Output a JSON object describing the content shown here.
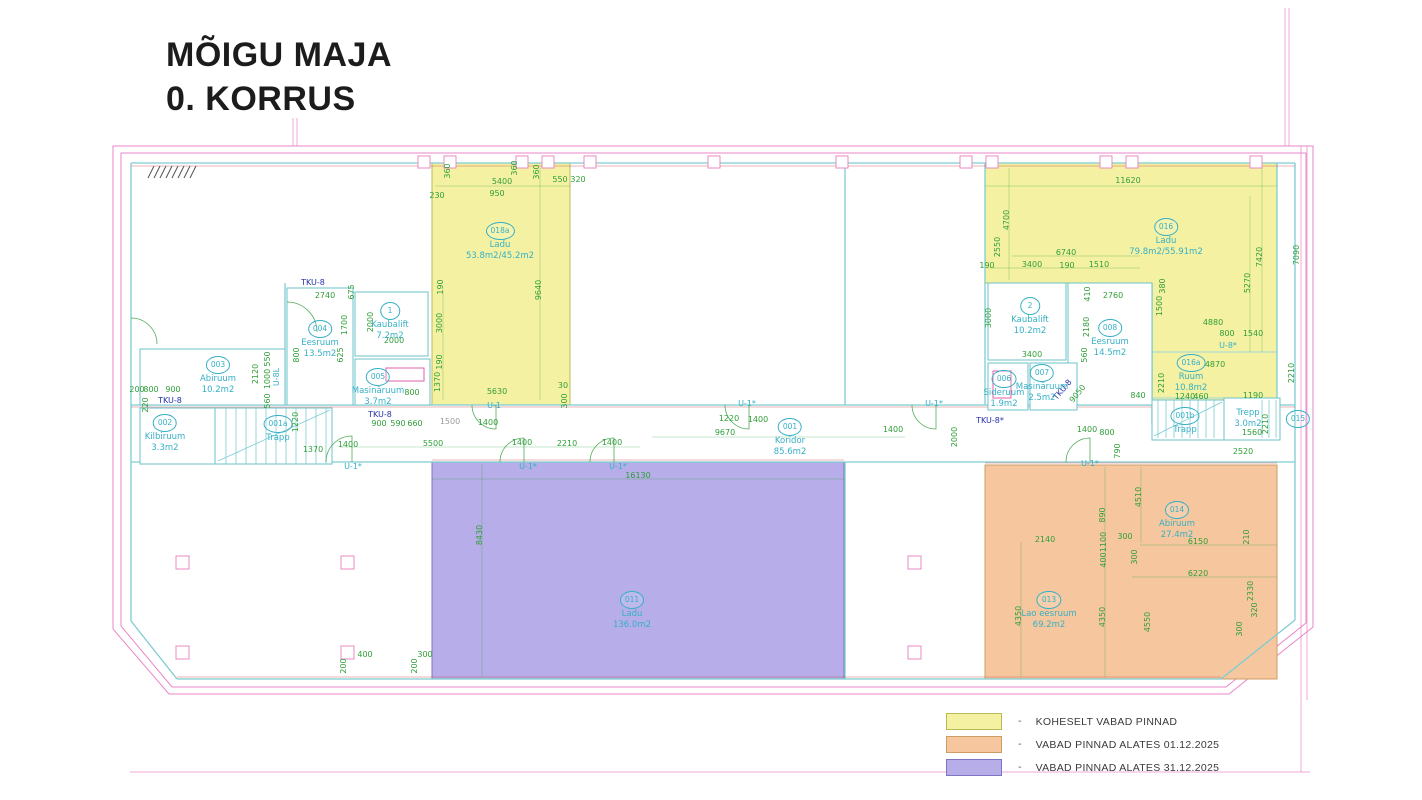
{
  "title": {
    "line1": "MÕIGU MAJA",
    "line2": "0. KORRUS"
  },
  "legend": {
    "separator": "-",
    "items": [
      {
        "key": "available_now",
        "label": "KOHESELT VABAD PINNAD"
      },
      {
        "key": "available_2025_12_01",
        "label": "VABAD PINNAD ALATES 01.12.2025"
      },
      {
        "key": "available_2025_12_31",
        "label": "VABAD PINNAD ALATES 31.12.2025"
      }
    ]
  },
  "colors": {
    "available_now": "#f5f1a2",
    "available_2025_12_01": "#f6c79e",
    "available_2025_12_31": "#b6ade9",
    "dimension_green": "#2f9e38",
    "room_label_cyan": "#35b0c6",
    "reference_navy": "#2430a8",
    "wall_teal": "#7ecdd2",
    "outline_pink": "#ea86c8"
  },
  "plan": {
    "rooms": [
      {
        "x": 500,
        "y": 222,
        "number": "018a",
        "name": "Ladu",
        "area": "53.8m2/45.2m2"
      },
      {
        "x": 1166,
        "y": 218,
        "number": "016",
        "name": "Ladu",
        "area": "79.8m2/55.91m2"
      },
      {
        "x": 1191,
        "y": 354,
        "number": "016a",
        "name": "Ruum",
        "area": "10.8m2"
      },
      {
        "x": 390,
        "y": 302,
        "number": "1",
        "name": "Kaubalift",
        "area": "7.2m2"
      },
      {
        "x": 1030,
        "y": 297,
        "number": "2",
        "name": "Kaubalift",
        "area": "10.2m2"
      },
      {
        "x": 320,
        "y": 320,
        "number": "004",
        "name": "Eesruum",
        "area": "13.5m2"
      },
      {
        "x": 378,
        "y": 368,
        "number": "005",
        "name": "Masinäruum",
        "area": "3.7m2"
      },
      {
        "x": 218,
        "y": 356,
        "number": "003",
        "name": "Abiruum",
        "area": "10.2m2"
      },
      {
        "x": 165,
        "y": 414,
        "number": "002",
        "name": "Kilbiruum",
        "area": "3.3m2"
      },
      {
        "x": 278,
        "y": 415,
        "number": "001a",
        "name": "Trapp",
        "area": ""
      },
      {
        "x": 790,
        "y": 418,
        "number": "001",
        "name": "Koridor",
        "area": "85.6m2"
      },
      {
        "x": 1185,
        "y": 407,
        "number": "001b",
        "name": "Trapp",
        "area": ""
      },
      {
        "x": 1004,
        "y": 370,
        "number": "006",
        "name": "Sideruum",
        "area": "1.9m2"
      },
      {
        "x": 1042,
        "y": 364,
        "number": "007",
        "name": "Masinäruum",
        "area": "2.5m2"
      },
      {
        "x": 1110,
        "y": 319,
        "number": "008",
        "name": "Eesruum",
        "area": "14.5m2"
      },
      {
        "x": 632,
        "y": 591,
        "number": "011",
        "name": "Ladu",
        "area": "136.0m2"
      },
      {
        "x": 1049,
        "y": 591,
        "number": "013",
        "name": "Lao eesruum",
        "area": "69.2m2"
      },
      {
        "x": 1177,
        "y": 501,
        "number": "014",
        "name": "Abiruum",
        "area": "27.4m2"
      },
      {
        "x": 1298,
        "y": 410,
        "number": "015",
        "name": "",
        "area": ""
      },
      {
        "x": 1248,
        "y": 408,
        "number": "",
        "name": "Trepp",
        "area": "3.0m2"
      }
    ],
    "annotations": [
      {
        "x": 502,
        "y": 182,
        "t": "5400"
      },
      {
        "x": 497,
        "y": 194,
        "t": "950"
      },
      {
        "x": 560,
        "y": 180,
        "t": "550"
      },
      {
        "x": 578,
        "y": 180,
        "t": "320"
      },
      {
        "x": 437,
        "y": 196,
        "t": "230"
      },
      {
        "x": 448,
        "y": 171,
        "t": "360",
        "r": -90
      },
      {
        "x": 515,
        "y": 168,
        "t": "360",
        "r": -90
      },
      {
        "x": 537,
        "y": 172,
        "t": "360",
        "r": -90
      },
      {
        "x": 441,
        "y": 287,
        "t": "190",
        "r": -90
      },
      {
        "x": 440,
        "y": 323,
        "t": "3000",
        "r": -90
      },
      {
        "x": 440,
        "y": 362,
        "t": "190",
        "r": -90
      },
      {
        "x": 438,
        "y": 382,
        "t": "1370",
        "r": -90
      },
      {
        "x": 497,
        "y": 392,
        "t": "5630"
      },
      {
        "x": 563,
        "y": 386,
        "t": "30"
      },
      {
        "x": 565,
        "y": 401,
        "t": "300",
        "r": -90
      },
      {
        "x": 539,
        "y": 290,
        "t": "9640",
        "r": -90
      },
      {
        "x": 325,
        "y": 296,
        "t": "2740"
      },
      {
        "x": 352,
        "y": 292,
        "t": "675",
        "r": -90
      },
      {
        "x": 345,
        "y": 325,
        "t": "1700",
        "r": -90
      },
      {
        "x": 371,
        "y": 322,
        "t": "2000",
        "r": -90
      },
      {
        "x": 394,
        "y": 341,
        "t": "2000"
      },
      {
        "x": 341,
        "y": 355,
        "t": "625",
        "r": -90
      },
      {
        "x": 297,
        "y": 355,
        "t": "800",
        "r": -90
      },
      {
        "x": 137,
        "y": 390,
        "t": "200"
      },
      {
        "x": 151,
        "y": 390,
        "t": "800"
      },
      {
        "x": 173,
        "y": 390,
        "t": "900"
      },
      {
        "x": 146,
        "y": 405,
        "t": "220",
        "r": -90
      },
      {
        "x": 256,
        "y": 374,
        "t": "2120",
        "r": -90
      },
      {
        "x": 268,
        "y": 379,
        "t": "1000",
        "r": -90
      },
      {
        "x": 268,
        "y": 359,
        "t": "550",
        "r": -90
      },
      {
        "x": 268,
        "y": 401,
        "t": "560",
        "r": -90
      },
      {
        "x": 296,
        "y": 422,
        "t": "1220",
        "r": -90
      },
      {
        "x": 313,
        "y": 450,
        "t": "1370"
      },
      {
        "x": 412,
        "y": 393,
        "t": "800"
      },
      {
        "x": 379,
        "y": 424,
        "t": "900"
      },
      {
        "x": 398,
        "y": 424,
        "t": "590"
      },
      {
        "x": 415,
        "y": 424,
        "t": "660"
      },
      {
        "x": 450,
        "y": 422,
        "t": "1500",
        "c": "gy"
      },
      {
        "x": 488,
        "y": 423,
        "t": "1400"
      },
      {
        "x": 348,
        "y": 445,
        "t": "1400"
      },
      {
        "x": 433,
        "y": 444,
        "t": "5500"
      },
      {
        "x": 522,
        "y": 443,
        "t": "1400"
      },
      {
        "x": 567,
        "y": 444,
        "t": "2210"
      },
      {
        "x": 612,
        "y": 443,
        "t": "1400"
      },
      {
        "x": 638,
        "y": 476,
        "t": "16130"
      },
      {
        "x": 725,
        "y": 433,
        "t": "9670"
      },
      {
        "x": 729,
        "y": 419,
        "t": "1220"
      },
      {
        "x": 758,
        "y": 420,
        "t": "1400"
      },
      {
        "x": 893,
        "y": 430,
        "t": "1400"
      },
      {
        "x": 955,
        "y": 437,
        "t": "2000",
        "r": -90
      },
      {
        "x": 1087,
        "y": 430,
        "t": "1400"
      },
      {
        "x": 1107,
        "y": 433,
        "t": "800"
      },
      {
        "x": 1118,
        "y": 451,
        "t": "790",
        "r": -90
      },
      {
        "x": 480,
        "y": 535,
        "t": "8430",
        "r": -90
      },
      {
        "x": 989,
        "y": 318,
        "t": "3000",
        "r": -90
      },
      {
        "x": 1032,
        "y": 355,
        "t": "3400"
      },
      {
        "x": 1087,
        "y": 327,
        "t": "2180",
        "r": -90
      },
      {
        "x": 1113,
        "y": 296,
        "t": "2760"
      },
      {
        "x": 1088,
        "y": 294,
        "t": "410",
        "r": -90
      },
      {
        "x": 1085,
        "y": 355,
        "t": "560",
        "r": -90
      },
      {
        "x": 1138,
        "y": 396,
        "t": "840"
      },
      {
        "x": 1078,
        "y": 394,
        "t": "9050",
        "r": -50
      },
      {
        "x": 1128,
        "y": 181,
        "t": "11620"
      },
      {
        "x": 1007,
        "y": 220,
        "t": "4700",
        "r": -90
      },
      {
        "x": 998,
        "y": 247,
        "t": "2550",
        "r": -90
      },
      {
        "x": 1066,
        "y": 253,
        "t": "6740"
      },
      {
        "x": 1032,
        "y": 265,
        "t": "3400"
      },
      {
        "x": 987,
        "y": 266,
        "t": "190"
      },
      {
        "x": 1067,
        "y": 266,
        "t": "190"
      },
      {
        "x": 1099,
        "y": 265,
        "t": "1510"
      },
      {
        "x": 1260,
        "y": 257,
        "t": "7420",
        "r": -90
      },
      {
        "x": 1248,
        "y": 283,
        "t": "5270",
        "r": -90
      },
      {
        "x": 1163,
        "y": 286,
        "t": "380",
        "r": -90
      },
      {
        "x": 1160,
        "y": 306,
        "t": "1500",
        "r": -90
      },
      {
        "x": 1213,
        "y": 323,
        "t": "4880"
      },
      {
        "x": 1227,
        "y": 334,
        "t": "800"
      },
      {
        "x": 1253,
        "y": 334,
        "t": "1540"
      },
      {
        "x": 1215,
        "y": 365,
        "t": "4870"
      },
      {
        "x": 1162,
        "y": 383,
        "t": "2210",
        "r": -90
      },
      {
        "x": 1185,
        "y": 397,
        "t": "1240"
      },
      {
        "x": 1201,
        "y": 397,
        "t": "460"
      },
      {
        "x": 1253,
        "y": 396,
        "t": "1190"
      },
      {
        "x": 1292,
        "y": 373,
        "t": "2210",
        "r": -90
      },
      {
        "x": 1297,
        "y": 255,
        "t": "7090",
        "r": -90
      },
      {
        "x": 1252,
        "y": 433,
        "t": "1560"
      },
      {
        "x": 1266,
        "y": 424,
        "t": "2210",
        "r": -90
      },
      {
        "x": 1243,
        "y": 452,
        "t": "2520"
      },
      {
        "x": 1045,
        "y": 540,
        "t": "2140"
      },
      {
        "x": 1103,
        "y": 515,
        "t": "890",
        "r": -90
      },
      {
        "x": 1104,
        "y": 542,
        "t": "1100",
        "r": -90
      },
      {
        "x": 1104,
        "y": 560,
        "t": "400",
        "r": -90
      },
      {
        "x": 1139,
        "y": 497,
        "t": "4510",
        "r": -90
      },
      {
        "x": 1125,
        "y": 537,
        "t": "300"
      },
      {
        "x": 1135,
        "y": 557,
        "t": "300",
        "r": -90
      },
      {
        "x": 1198,
        "y": 542,
        "t": "6150"
      },
      {
        "x": 1198,
        "y": 574,
        "t": "6220"
      },
      {
        "x": 1019,
        "y": 616,
        "t": "4350",
        "r": -90
      },
      {
        "x": 1103,
        "y": 617,
        "t": "4350",
        "r": -90
      },
      {
        "x": 1148,
        "y": 622,
        "t": "4550",
        "r": -90
      },
      {
        "x": 1251,
        "y": 591,
        "t": "2330",
        "r": -90
      },
      {
        "x": 1255,
        "y": 610,
        "t": "320",
        "r": -90
      },
      {
        "x": 1240,
        "y": 629,
        "t": "300",
        "r": -90
      },
      {
        "x": 1247,
        "y": 537,
        "t": "210",
        "r": -90
      },
      {
        "x": 365,
        "y": 655,
        "t": "400"
      },
      {
        "x": 425,
        "y": 655,
        "t": "300"
      },
      {
        "x": 344,
        "y": 666,
        "t": "200",
        "r": -90
      },
      {
        "x": 415,
        "y": 666,
        "t": "200",
        "r": -90
      },
      {
        "x": 494,
        "y": 406,
        "t": "U-1",
        "c": "c"
      },
      {
        "x": 353,
        "y": 467,
        "t": "U-1*",
        "c": "c"
      },
      {
        "x": 528,
        "y": 467,
        "t": "U-1*",
        "c": "c"
      },
      {
        "x": 618,
        "y": 467,
        "t": "U-1*",
        "c": "c"
      },
      {
        "x": 747,
        "y": 404,
        "t": "U-1*",
        "c": "c"
      },
      {
        "x": 934,
        "y": 404,
        "t": "U-1*",
        "c": "c"
      },
      {
        "x": 1090,
        "y": 464,
        "t": "U-1*",
        "c": "c"
      },
      {
        "x": 277,
        "y": 377,
        "t": "U-8L",
        "r": -90,
        "c": "c"
      },
      {
        "x": 1228,
        "y": 346,
        "t": "U-8*",
        "c": "c"
      },
      {
        "x": 313,
        "y": 283,
        "t": "TKU-8",
        "c": "n"
      },
      {
        "x": 170,
        "y": 401,
        "t": "TKU-8",
        "c": "n"
      },
      {
        "x": 380,
        "y": 415,
        "t": "TKU-8",
        "c": "n"
      },
      {
        "x": 990,
        "y": 421,
        "t": "TKU-8*",
        "c": "n"
      },
      {
        "x": 1063,
        "y": 390,
        "t": "TKU-8",
        "r": -50,
        "c": "n"
      }
    ]
  }
}
